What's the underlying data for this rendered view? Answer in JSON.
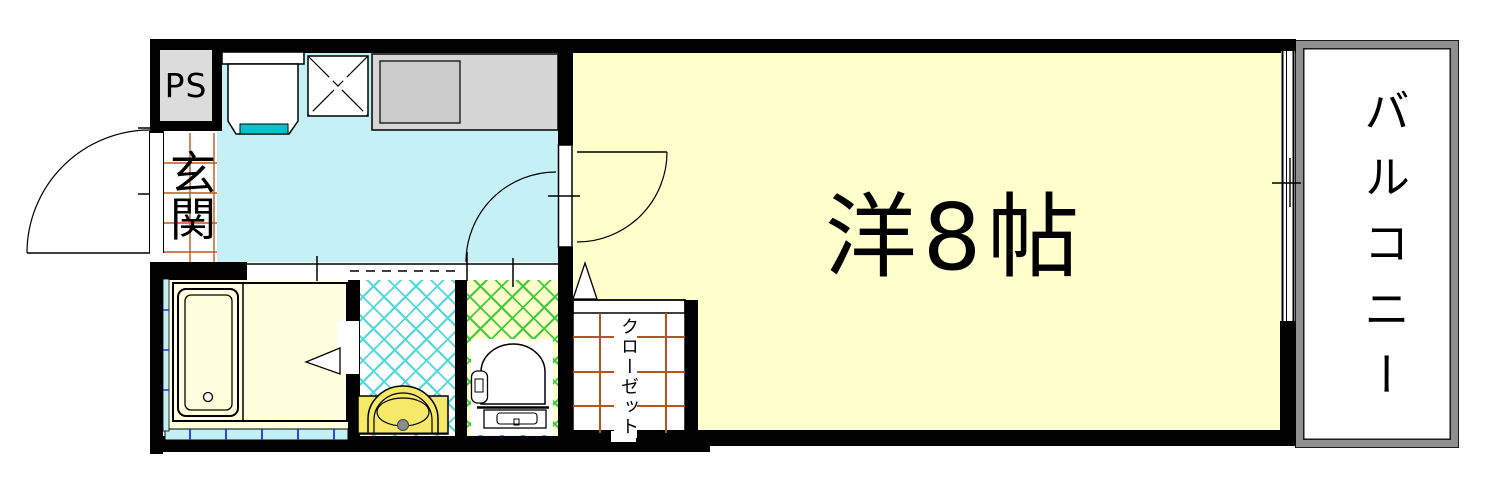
{
  "floorplan": {
    "title": "1K apartment floor plan",
    "labels": {
      "pipe_space": "PS",
      "entrance": "玄関",
      "main_room": "洋8帖",
      "closet": "クローゼット",
      "balcony": "バルコニー"
    },
    "rooms": [
      {
        "name": "entrance",
        "label": "玄関"
      },
      {
        "name": "kitchen",
        "label": ""
      },
      {
        "name": "bathroom",
        "label": ""
      },
      {
        "name": "washroom",
        "label": ""
      },
      {
        "name": "toilet-room",
        "label": ""
      },
      {
        "name": "closet",
        "label": "クローゼット"
      },
      {
        "name": "main-room",
        "label": "洋8帖"
      },
      {
        "name": "balcony",
        "label": "バルコニー"
      },
      {
        "name": "pipe-space",
        "label": "PS"
      }
    ],
    "fixtures": [
      {
        "name": "kitchen-sink",
        "room": "kitchen"
      },
      {
        "name": "stove-space",
        "room": "kitchen"
      },
      {
        "name": "counter",
        "room": "kitchen"
      },
      {
        "name": "bathtub",
        "room": "bathroom"
      },
      {
        "name": "wash-basin",
        "room": "washroom"
      },
      {
        "name": "toilet",
        "room": "toilet-room"
      },
      {
        "name": "entrance-door",
        "room": "entrance"
      },
      {
        "name": "room-door",
        "room": "main-room"
      },
      {
        "name": "sliding-door",
        "room": "washroom"
      },
      {
        "name": "sliding-window",
        "room": "main-room"
      },
      {
        "name": "bath-window",
        "room": "bathroom"
      }
    ],
    "colors": {
      "wall": "#000000",
      "main_room_bg": "#ffffcc",
      "kitchen_bg": "#c4f0f6",
      "bathroom_bg": "#ffffde",
      "toilet_bg": "#ffffcc",
      "toilet_hatch": "#3ecc3e",
      "washroom_hatch": "#50d8e0",
      "sink_teal": "#00c4c8",
      "basin_yellow": "#f6e96a",
      "counter_gray": "#d6d6d6",
      "ps_gray": "#dcdcdc",
      "railing_gray": "#8f8f8f",
      "tile_line_orange": "#c2571c",
      "closet_grid_orange": "#b5551c",
      "window_strip_cyan": "#c2f0f5"
    }
  }
}
